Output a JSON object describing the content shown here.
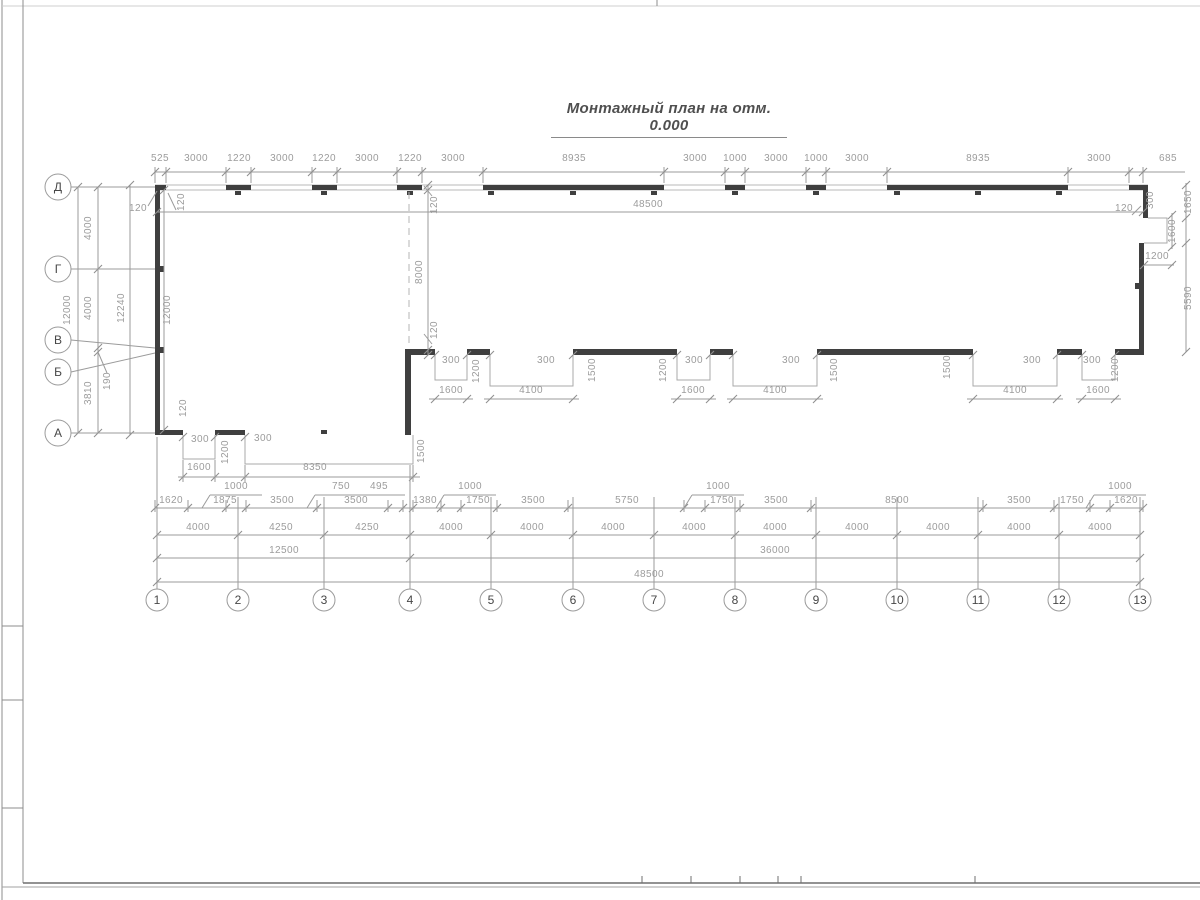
{
  "title": "Монтажный план на отм. 0.000",
  "colors": {
    "wall": "#3f3f3f",
    "thin_line": "#a9a9a9",
    "dim_line": "#9b9b9b",
    "dim_text": "#9c9c9c",
    "axis_text": "#474747",
    "bubble_stroke": "#9b9b9b",
    "frame": "#8c8c8c",
    "title_text": "#4f4f4f"
  },
  "row_axes": [
    {
      "label": "Д",
      "cx": 58,
      "cy": 187
    },
    {
      "label": "Г",
      "cx": 58,
      "cy": 269
    },
    {
      "label": "В",
      "cx": 58,
      "cy": 340
    },
    {
      "label": "Б",
      "cx": 58,
      "cy": 372
    },
    {
      "label": "А",
      "cx": 58,
      "cy": 433
    }
  ],
  "col_axes": [
    {
      "label": "1",
      "cx": 157,
      "cy": 600
    },
    {
      "label": "2",
      "cx": 238,
      "cy": 600
    },
    {
      "label": "3",
      "cx": 324,
      "cy": 600
    },
    {
      "label": "4",
      "cx": 410,
      "cy": 600
    },
    {
      "label": "5",
      "cx": 491,
      "cy": 600
    },
    {
      "label": "6",
      "cx": 573,
      "cy": 600
    },
    {
      "label": "7",
      "cx": 654,
      "cy": 600
    },
    {
      "label": "8",
      "cx": 735,
      "cy": 600
    },
    {
      "label": "9",
      "cx": 816,
      "cy": 600
    },
    {
      "label": "10",
      "cx": 897,
      "cy": 600
    },
    {
      "label": "11",
      "cx": 978,
      "cy": 600
    },
    {
      "label": "12",
      "cx": 1059,
      "cy": 600
    },
    {
      "label": "13",
      "cx": 1140,
      "cy": 600
    }
  ],
  "dim_labels": [
    {
      "t": "525",
      "x": 160,
      "y": 161
    },
    {
      "t": "3000",
      "x": 196,
      "y": 161
    },
    {
      "t": "1220",
      "x": 239,
      "y": 161
    },
    {
      "t": "3000",
      "x": 282,
      "y": 161
    },
    {
      "t": "1220",
      "x": 324,
      "y": 161
    },
    {
      "t": "3000",
      "x": 367,
      "y": 161
    },
    {
      "t": "1220",
      "x": 410,
      "y": 161
    },
    {
      "t": "3000",
      "x": 453,
      "y": 161
    },
    {
      "t": "8935",
      "x": 574,
      "y": 161
    },
    {
      "t": "3000",
      "x": 695,
      "y": 161
    },
    {
      "t": "1000",
      "x": 735,
      "y": 161
    },
    {
      "t": "3000",
      "x": 776,
      "y": 161
    },
    {
      "t": "1000",
      "x": 816,
      "y": 161
    },
    {
      "t": "3000",
      "x": 857,
      "y": 161
    },
    {
      "t": "8935",
      "x": 978,
      "y": 161
    },
    {
      "t": "3000",
      "x": 1099,
      "y": 161
    },
    {
      "t": "685",
      "x": 1168,
      "y": 161
    },
    {
      "t": "48500",
      "x": 648,
      "y": 207
    },
    {
      "t": "120",
      "x": 138,
      "y": 211
    },
    {
      "t": "120",
      "x": 184,
      "y": 202,
      "r": 1
    },
    {
      "t": "12000",
      "x": 70,
      "y": 310,
      "r": 1
    },
    {
      "t": "4000",
      "x": 91,
      "y": 228,
      "r": 1
    },
    {
      "t": "4000",
      "x": 91,
      "y": 308,
      "r": 1
    },
    {
      "t": "12240",
      "x": 124,
      "y": 308,
      "r": 1
    },
    {
      "t": "12000",
      "x": 170,
      "y": 310,
      "r": 1
    },
    {
      "t": "190",
      "x": 110,
      "y": 381,
      "r": 1
    },
    {
      "t": "3810",
      "x": 91,
      "y": 393,
      "r": 1
    },
    {
      "t": "120",
      "x": 186,
      "y": 408,
      "r": 1
    },
    {
      "t": "120",
      "x": 437,
      "y": 205,
      "r": 1
    },
    {
      "t": "8000",
      "x": 422,
      "y": 272,
      "r": 1
    },
    {
      "t": "120",
      "x": 437,
      "y": 330,
      "r": 1
    },
    {
      "t": "120",
      "x": 1124,
      "y": 211
    },
    {
      "t": "300",
      "x": 1153,
      "y": 200,
      "r": 1
    },
    {
      "t": "1650",
      "x": 1191,
      "y": 202,
      "r": 1
    },
    {
      "t": "1600",
      "x": 1175,
      "y": 231,
      "r": 1
    },
    {
      "t": "1200",
      "x": 1157,
      "y": 259
    },
    {
      "t": "5590",
      "x": 1191,
      "y": 298,
      "r": 1
    },
    {
      "t": "300",
      "x": 451,
      "y": 363
    },
    {
      "t": "1200",
      "x": 479,
      "y": 371,
      "r": 1
    },
    {
      "t": "1600",
      "x": 451,
      "y": 393
    },
    {
      "t": "300",
      "x": 546,
      "y": 363
    },
    {
      "t": "1500",
      "x": 595,
      "y": 370,
      "r": 1
    },
    {
      "t": "4100",
      "x": 531,
      "y": 393
    },
    {
      "t": "1200",
      "x": 666,
      "y": 370,
      "r": 1
    },
    {
      "t": "300",
      "x": 694,
      "y": 363
    },
    {
      "t": "1600",
      "x": 693,
      "y": 393
    },
    {
      "t": "300",
      "x": 791,
      "y": 363
    },
    {
      "t": "1500",
      "x": 837,
      "y": 370,
      "r": 1
    },
    {
      "t": "4100",
      "x": 775,
      "y": 393
    },
    {
      "t": "1500",
      "x": 950,
      "y": 367,
      "r": 1
    },
    {
      "t": "300",
      "x": 1032,
      "y": 363
    },
    {
      "t": "4100",
      "x": 1015,
      "y": 393
    },
    {
      "t": "300",
      "x": 1092,
      "y": 363
    },
    {
      "t": "1200",
      "x": 1118,
      "y": 370,
      "r": 1
    },
    {
      "t": "1600",
      "x": 1098,
      "y": 393
    },
    {
      "t": "300",
      "x": 200,
      "y": 442
    },
    {
      "t": "1200",
      "x": 228,
      "y": 452,
      "r": 1
    },
    {
      "t": "300",
      "x": 263,
      "y": 441
    },
    {
      "t": "1500",
      "x": 424,
      "y": 451,
      "r": 1
    },
    {
      "t": "1600",
      "x": 199,
      "y": 470
    },
    {
      "t": "8350",
      "x": 315,
      "y": 470
    },
    {
      "t": "1000",
      "x": 236,
      "y": 489
    },
    {
      "t": "750",
      "x": 341,
      "y": 489
    },
    {
      "t": "495",
      "x": 379,
      "y": 489
    },
    {
      "t": "1000",
      "x": 470,
      "y": 489
    },
    {
      "t": "1000",
      "x": 718,
      "y": 489
    },
    {
      "t": "1000",
      "x": 1120,
      "y": 489
    },
    {
      "t": "1620",
      "x": 171,
      "y": 503
    },
    {
      "t": "1875",
      "x": 225,
      "y": 503
    },
    {
      "t": "3500",
      "x": 282,
      "y": 503
    },
    {
      "t": "3500",
      "x": 356,
      "y": 503
    },
    {
      "t": "1380",
      "x": 425,
      "y": 503
    },
    {
      "t": "1750",
      "x": 478,
      "y": 503
    },
    {
      "t": "3500",
      "x": 533,
      "y": 503
    },
    {
      "t": "5750",
      "x": 627,
      "y": 503
    },
    {
      "t": "1750",
      "x": 722,
      "y": 503
    },
    {
      "t": "3500",
      "x": 776,
      "y": 503
    },
    {
      "t": "8500",
      "x": 897,
      "y": 503
    },
    {
      "t": "3500",
      "x": 1019,
      "y": 503
    },
    {
      "t": "1750",
      "x": 1072,
      "y": 503
    },
    {
      "t": "1620",
      "x": 1126,
      "y": 503
    },
    {
      "t": "4000",
      "x": 198,
      "y": 530
    },
    {
      "t": "4250",
      "x": 281,
      "y": 530
    },
    {
      "t": "4250",
      "x": 367,
      "y": 530
    },
    {
      "t": "4000",
      "x": 451,
      "y": 530
    },
    {
      "t": "4000",
      "x": 532,
      "y": 530
    },
    {
      "t": "4000",
      "x": 613,
      "y": 530
    },
    {
      "t": "4000",
      "x": 694,
      "y": 530
    },
    {
      "t": "4000",
      "x": 775,
      "y": 530
    },
    {
      "t": "4000",
      "x": 857,
      "y": 530
    },
    {
      "t": "4000",
      "x": 938,
      "y": 530
    },
    {
      "t": "4000",
      "x": 1019,
      "y": 530
    },
    {
      "t": "4000",
      "x": 1100,
      "y": 530
    },
    {
      "t": "12500",
      "x": 284,
      "y": 553
    },
    {
      "t": "36000",
      "x": 775,
      "y": 553
    },
    {
      "t": "48500",
      "x": 649,
      "y": 577
    }
  ]
}
